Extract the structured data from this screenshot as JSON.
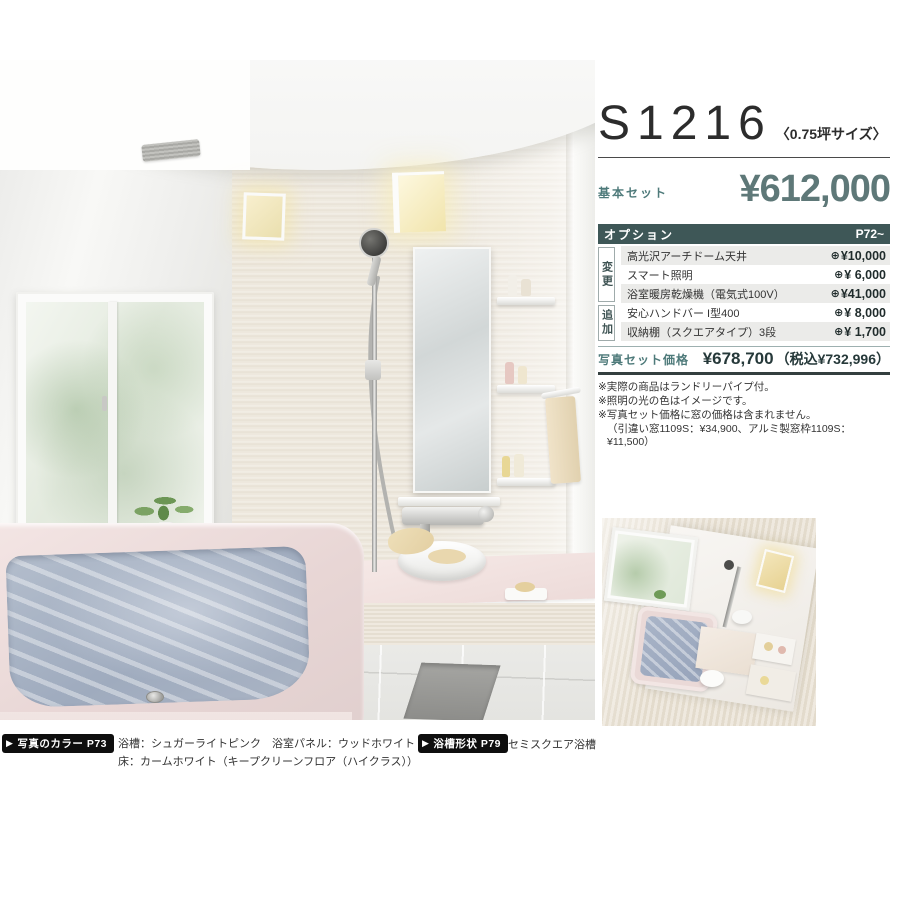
{
  "header": {
    "model": "S1216",
    "size_note": "〈0.75坪サイズ〉",
    "base_set_label": "基本セット",
    "base_price": "¥612,000"
  },
  "options": {
    "title": "オプション",
    "page_ref": "P72~",
    "group_change": "変更",
    "group_add": "追加",
    "plus_icon": "⊕",
    "rows": [
      {
        "name": "高光沢アーチドーム天井",
        "price": "¥10,000"
      },
      {
        "name": "スマート照明",
        "price": "¥ 6,000"
      },
      {
        "name": "浴室暖房乾燥機（電気式100V）",
        "price": "¥41,000"
      },
      {
        "name": "安心ハンドバー I型400",
        "price": "¥ 8,000"
      },
      {
        "name": "収納棚（スクエアタイプ）3段",
        "price": "¥ 1,700"
      }
    ]
  },
  "photo_set": {
    "label": "写真セット価格",
    "price": "¥678,700",
    "tax_note": "（税込¥732,996）"
  },
  "notes": [
    "※実際の商品はランドリーパイプ付。",
    "※照明の光の色はイメージです。",
    "※写真セット価格に窓の価格は含まれません。",
    "（引違い窓1109S：¥34,900、アルミ製窓枠1109S：¥11,500）"
  ],
  "footer": {
    "arrow_icon": "▶",
    "color_badge": "写真のカラー P73",
    "color_line1": "浴槽：シュガーライトピンク　浴室パネル：ウッドホワイト",
    "color_line2": "床：カームホワイト（キープクリーンフロア（ハイクラス））",
    "shape_badge": "浴槽形状 P79",
    "shape_text": "セミスクエア浴槽"
  },
  "colors": {
    "accent_teal": "#3e5757",
    "price_teal": "#5e7878",
    "label_teal": "#4e7a7a"
  }
}
